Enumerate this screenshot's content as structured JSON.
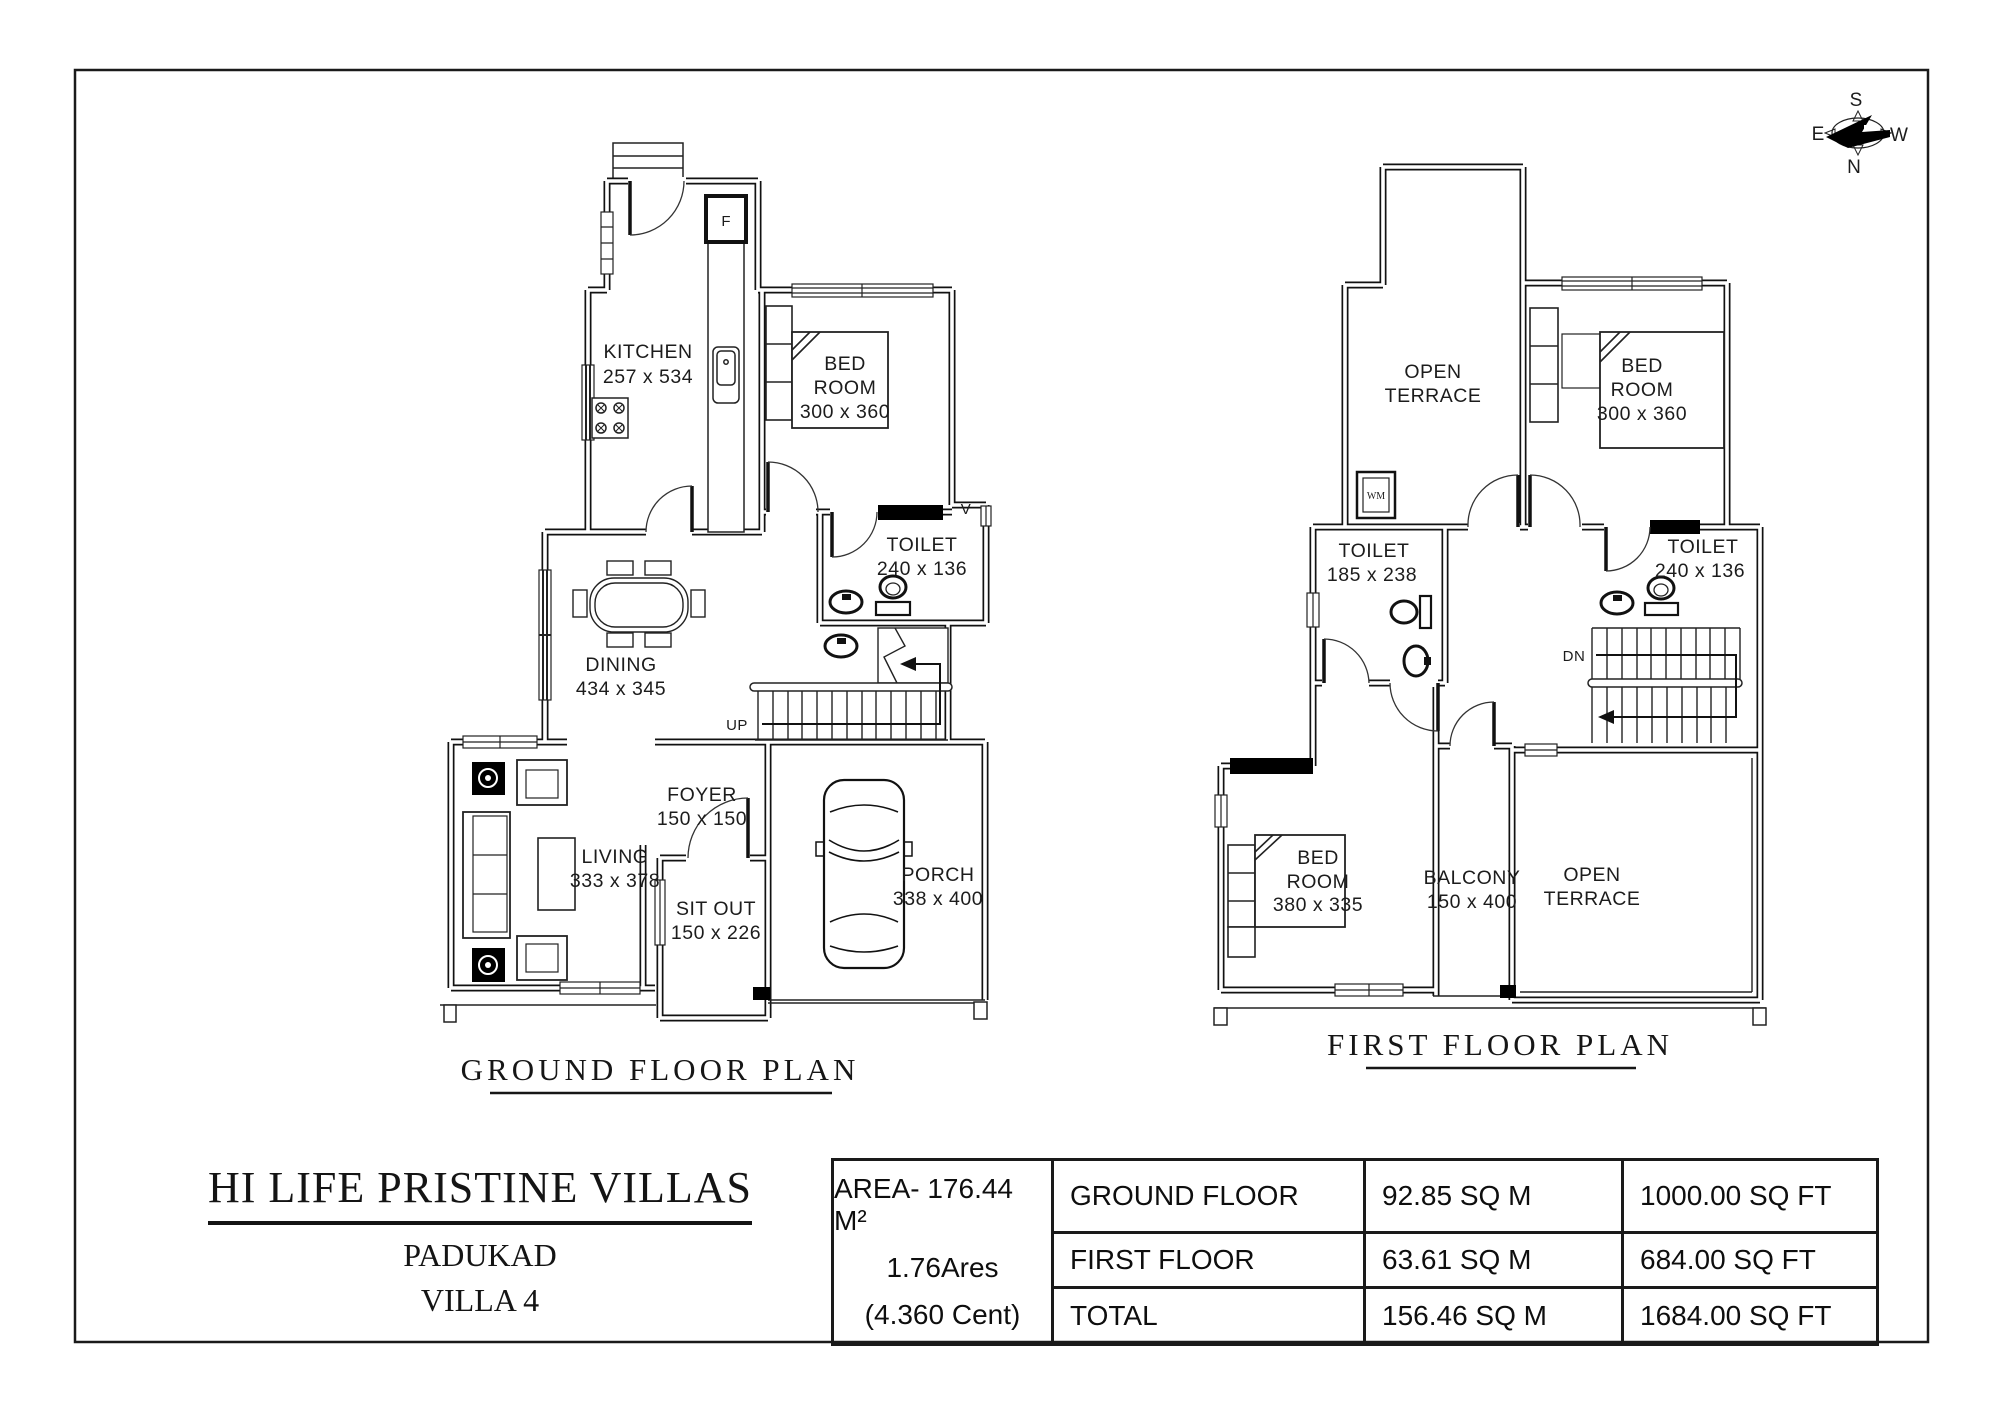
{
  "compass": {
    "n": "N",
    "s": "S",
    "e": "E",
    "w": "W"
  },
  "ground_floor": {
    "title": "GROUND FLOOR PLAN",
    "labels": {
      "kitchen": {
        "name": "KITCHEN",
        "dims": "257 x 534"
      },
      "bedroom": {
        "line1": "BED",
        "line2": "ROOM",
        "dims": "300 x 360"
      },
      "toilet": {
        "name": "TOILET",
        "dims": "240 x 136"
      },
      "dining": {
        "name": "DINING",
        "dims": "434 x 345"
      },
      "foyer": {
        "name": "FOYER",
        "dims": "150 x 150"
      },
      "living": {
        "name": "LIVING",
        "dims": "333 x 378"
      },
      "sitout": {
        "name": "SIT OUT",
        "dims": "150 x 226"
      },
      "porch": {
        "name": "PORCH",
        "dims": "338 x 400"
      },
      "stairs": "UP",
      "fridge": "F",
      "vent": "V"
    }
  },
  "first_floor": {
    "title": "FIRST FLOOR PLAN",
    "labels": {
      "open_terrace_top": {
        "line1": "OPEN",
        "line2": "TERRACE"
      },
      "bedroom1": {
        "line1": "BED",
        "line2": "ROOM",
        "dims": "300 x 360"
      },
      "toilet1": {
        "name": "TOILET",
        "dims": "185 x 238"
      },
      "toilet2": {
        "name": "TOILET",
        "dims": "240 x 136"
      },
      "bedroom2": {
        "line1": "BED",
        "line2": "ROOM",
        "dims": "380 x 335"
      },
      "balcony": {
        "name": "BALCONY",
        "dims": "150 x 400"
      },
      "open_terrace_bottom": {
        "line1": "OPEN",
        "line2": "TERRACE"
      },
      "stairs": "DN",
      "washing_machine": "WM"
    }
  },
  "title_block": {
    "company": "HI LIFE PRISTINE VILLAS",
    "location": "PADUKAD",
    "unit": "VILLA 4"
  },
  "area_table": {
    "summary": {
      "line1": "AREA- 176.44 M²",
      "line2": "1.76Ares",
      "line3": "(4.360 Cent)"
    },
    "rows": [
      {
        "label": "GROUND FLOOR",
        "sqm": "92.85 SQ M",
        "sqft": "1000.00 SQ FT"
      },
      {
        "label": "FIRST FLOOR",
        "sqm": "63.61 SQ M",
        "sqft": "684.00 SQ FT"
      },
      {
        "label": "TOTAL",
        "sqm": "156.46 SQ M",
        "sqft": "1684.00 SQ FT"
      }
    ]
  }
}
